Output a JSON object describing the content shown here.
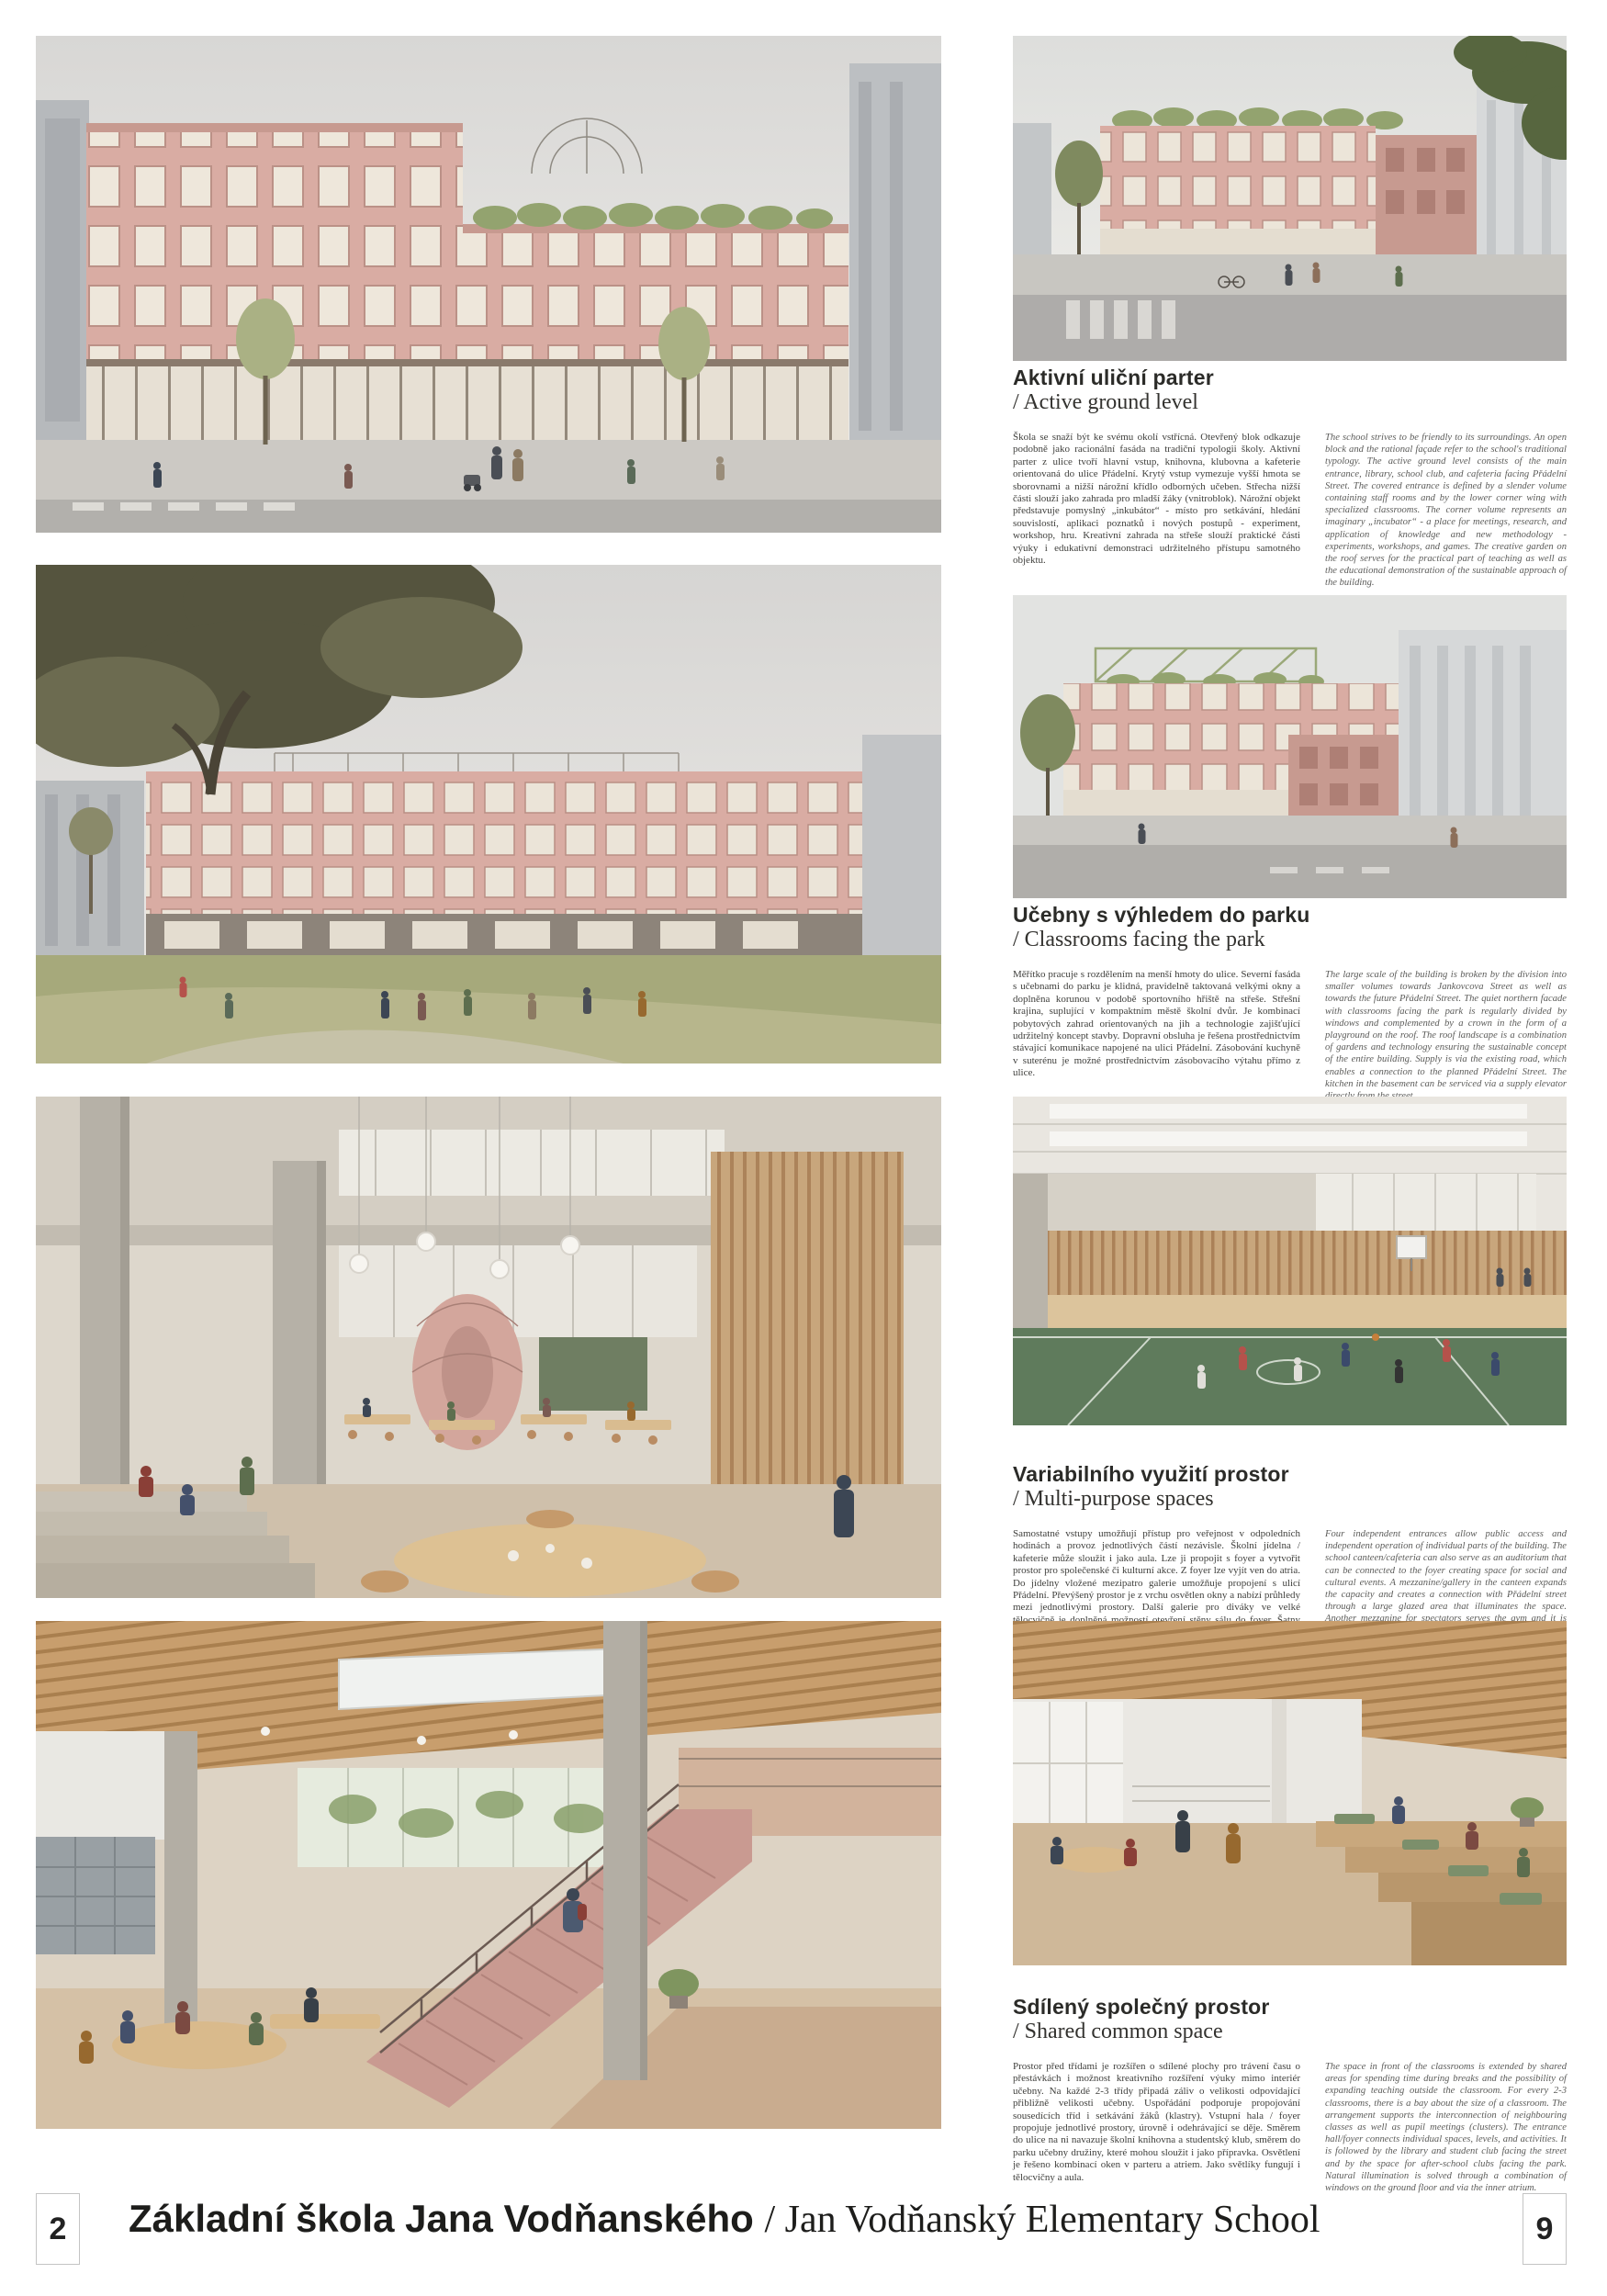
{
  "palette": {
    "facade_pink": "#d9aca3",
    "roof_green": "#93a36f",
    "wood": "#c8a67c",
    "gym_floor": "#5f7b5c",
    "heading_text": "#2b2b28",
    "body_text_cs": "#3f3f3c",
    "body_text_en": "#5c5c5a"
  },
  "sections": [
    {
      "heading_cs": "Aktivní uliční parter",
      "heading_en": "/ Active ground level",
      "body_cs": "Škola se snaží být ke svému okolí vstřícná. Otevřený blok odkazuje podobně jako racionální fasáda na tradiční typologii školy. Aktivní parter z ulice tvoří hlavní vstup, knihovna, klubovna a kafeterie orientovaná do ulice Přádelní. Krytý vstup vymezuje vyšší hmota se sborovnami a nižší nárožní křídlo odborných učeben. Střecha nižší části slouží jako zahrada pro mladší žáky (vnitroblok). Nárožní objekt představuje pomyslný „inkubátor“ - místo pro setkávání, hledání souvislostí, aplikaci poznatků i nových postupů - experiment, workshop, hru. Kreativní zahrada na střeše slouží praktické části výuky i edukativní demonstraci udržitelného přístupu samotného objektu.",
      "body_en": "The school strives to be friendly to its surroundings. An open block and the rational façade refer to the school's traditional typology. The active ground level consists of the main entrance, library, school club, and cafeteria facing Přádelní Street. The covered entrance is defined by a slender volume containing staff rooms and by the lower corner wing with specialized classrooms. The corner volume represents an imaginary „incubator“ - a place for meetings, research, and application of knowledge and new methodology - experiments, workshops, and games. The creative garden on the roof serves for the practical part of teaching as well as the educational demonstration of the sustainable approach of the building."
    },
    {
      "heading_cs": "Učebny s výhledem do parku",
      "heading_en": "/ Classrooms facing the park",
      "body_cs": "Měřítko pracuje s rozdělením na menší hmoty do ulice. Severní fasáda s učebnami do parku je klidná, pravidelně taktovaná velkými okny a doplněna korunou v podobě sportovního hřiště na střeše. Střešní krajina, suplující v kompaktním městě školní dvůr. Je kombinací pobytových zahrad orientovaných na jih a technologie zajišťující udržitelný koncept stavby. Dopravní obsluha je řešena prostřednictvím stávající komunikace napojené na ulici Přádelní. Zásobování kuchyně v suterénu je možné prostřednictvím zásobovacího výtahu přímo z ulice.",
      "body_en": "The large scale of the building is broken by the division into smaller volumes towards Jankovcova Street as well as towards the future Přádelní Street. The quiet northern facade with classrooms facing the park is regularly divided by windows and complemented by a crown in the form of a playground on the roof. The roof landscape is a combination of gardens and technology ensuring the sustainable concept of the entire building. Supply is via the existing road, which enables a connection to the planned Přádelní Street. The kitchen in the basement can be serviced via a supply elevator directly from the street."
    },
    {
      "heading_cs": "Variabilního využití prostor",
      "heading_en": "/ Multi-purpose spaces",
      "body_cs": "Samostatné vstupy umožňují přístup pro veřejnost v odpoledních hodinách a provoz jednotlivých částí nezávisle. Školní jídelna / kafeterie může sloužit i jako aula. Lze ji propojit s foyer a vytvořit prostor pro společenské či kulturní akce. Z foyer lze vyjít ven do atria. Do jídelny vložené mezipatro galerie umožňuje propojení s ulicí Přádelní. Převýšený prostor je z vrchu osvětlen okny a nabízí průhledy mezi jednotlivými prostory. Další galerie pro diváky ve velké tělocvičně je doplněná možností otevření stěny sálu do foyer. Šatny sportovců je možné použít i jako zázemí pro účinkující - např. divadelní představení, zkoušky pěveckého sboru nebo konání konference.",
      "body_en": "Four independent entrances allow public access and independent operation of individual parts of the building. The school canteen/cafeteria can also serve as an auditorium that can be connected to the foyer creating space for social and cultural events. A mezzanine/gallery in the canteen expands the capacity and creates a connection with Přádelní street through a large glazed area that illuminates the space. Another mezzanine for spectators serves the gym and it is supplemented by the option of opening the glazed partition directly to the foyer. Changing rooms for sports can also be used as a backstage for performers—for example, theatre, choral concerts, and conferences."
    },
    {
      "heading_cs": "Sdílený společný prostor",
      "heading_en": "/ Shared common space",
      "body_cs": "Prostor před třídami je rozšířen o sdílené plochy pro trávení času o přestávkách i možnost kreativního rozšíření výuky mimo interiér učebny. Na každé 2-3 třídy připadá záliv o velikosti odpovídající přibližně velikosti učebny. Uspořádání podporuje propojování sousedících tříd i setkávání žáků (klastry). Vstupní hala / foyer propojuje jednotlivé prostory, úrovně i odehrávající se děje. Směrem do ulice na ni navazuje školní knihovna a studentský klub, směrem do parku učebny družiny, které mohou sloužit i jako přípravka. Osvětlení je řešeno kombinací oken v parteru a atriem. Jako světlíky fungují i tělocvičny a aula.",
      "body_en": "The space in front of the classrooms is extended by shared areas for spending time during breaks and the possibility of expanding teaching outside the classroom. For every 2-3 classrooms, there is a bay about the size of a classroom. The arrangement supports the interconnection of neighbouring classes as well as pupil meetings (clusters). The entrance hall/foyer connects individual spaces, levels, and activities. It is followed by the library and student club facing the street and by the space for after-school clubs facing the park. Natural illumination is solved through a combination of windows on the ground floor and via the inner atrium."
    }
  ],
  "footer": {
    "page_number_left": "2",
    "page_number_right": "9",
    "title_cs": "Základní škola Jana Vodňanského ",
    "title_en": "/ Jan Vodňanský Elementary School"
  }
}
